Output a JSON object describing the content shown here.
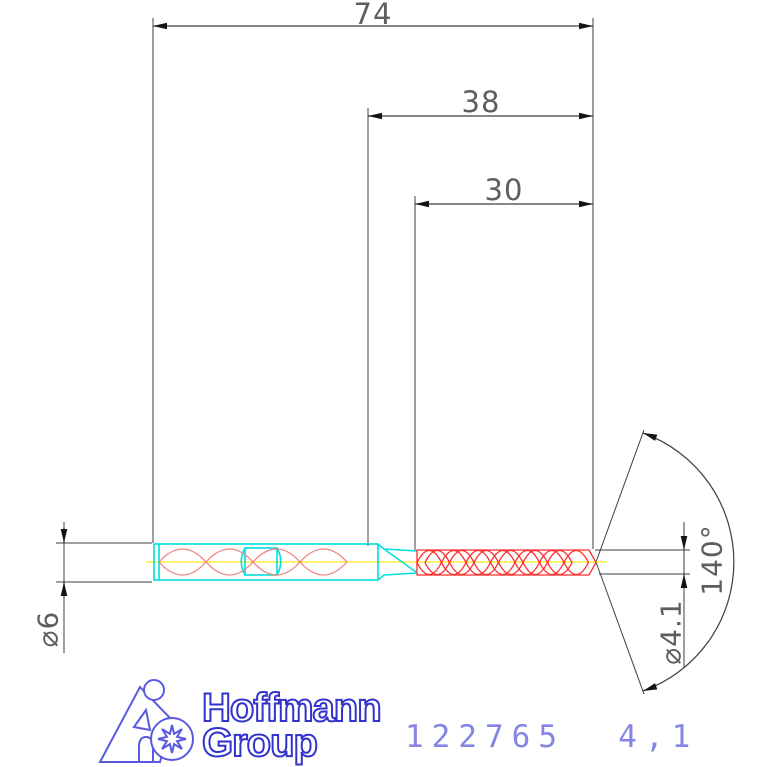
{
  "drawing_type": "technical drawing of a solid carbide drill",
  "dimensions": {
    "overall_length": "74",
    "usable_length": "38",
    "flute_length": "30",
    "shank_diameter": "⌀6",
    "drill_diameter": "⌀4.1",
    "point_angle": "140°"
  },
  "logo": {
    "line1": "Hoffmann",
    "line2": "Group"
  },
  "part_label": {
    "article_number": "122765",
    "size": "4,1",
    "combined": "122765  4,1"
  },
  "colors": {
    "dimension-line": "#3f3f3f",
    "dimension-text": "#5e5e5e",
    "arrow": "#141414",
    "body-cyan": "#00dede",
    "flute-red": "#ff2a2a",
    "shank-helix-red": "#ef8282",
    "centerline-yellow": "#ffec3d",
    "logo-blue": "#5a5ae0",
    "logo-text-blue": "#3232cc",
    "part-number-blue": "#8585e5"
  }
}
